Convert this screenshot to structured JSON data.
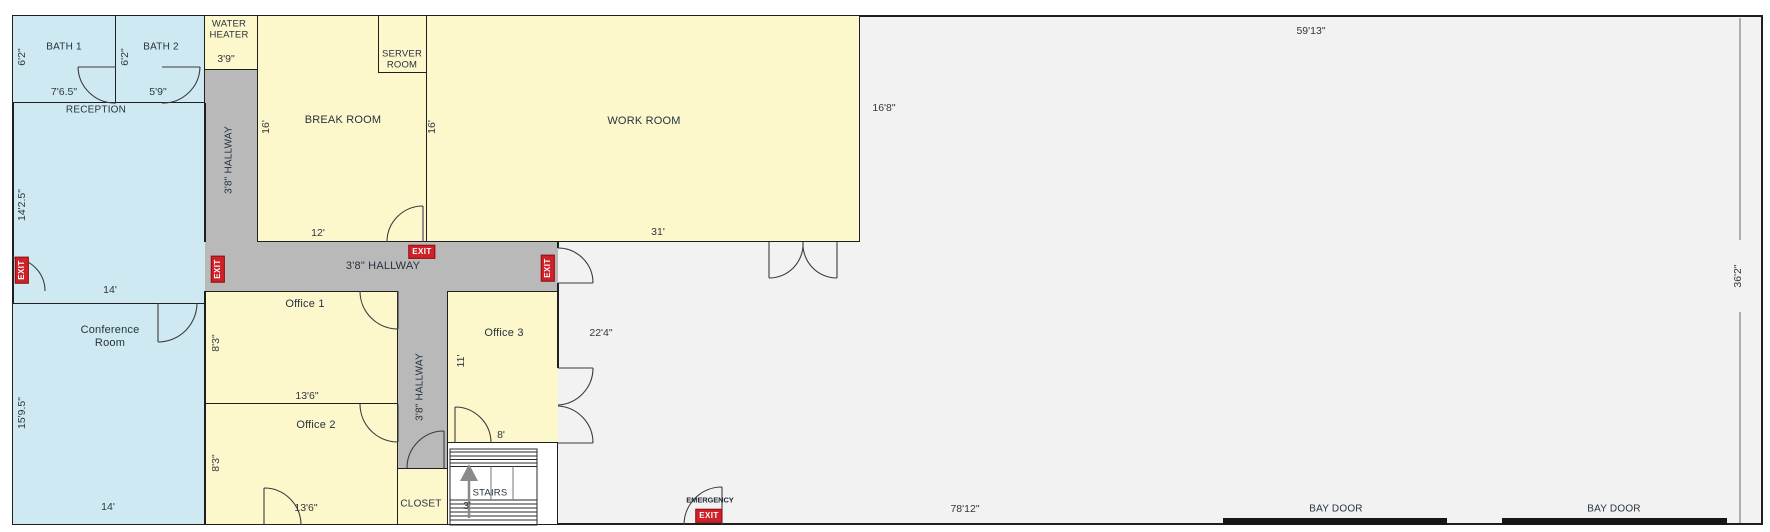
{
  "colors": {
    "room_blue": "#cfe9f2",
    "room_yellow": "#fdf7cc",
    "hallway_gray": "#b9b9b9",
    "warehouse_gray": "#f2f2f2",
    "wall": "#1f1f1f",
    "exit_red": "#cf2128",
    "label_text": "#26323e"
  },
  "rooms": {
    "bath1": {
      "label": "BATH 1",
      "height_dim": "6'2\"",
      "width_dim": "7'6.5\""
    },
    "bath2": {
      "label": "BATH 2",
      "height_dim": "6'2\"",
      "width_dim": "5'9\""
    },
    "reception": {
      "label": "RECEPTION",
      "height_dim": "14'2.5\"",
      "width_dim": "14'"
    },
    "conference": {
      "label": "Conference Room",
      "height_dim": "15'9.5\"",
      "width_dim": "14'"
    },
    "water_heater": {
      "label": "WATER HEATER",
      "width_dim": "3'9\""
    },
    "hallway_top": {
      "label": "3'8\" HALLWAY"
    },
    "break_room": {
      "label": "BREAK ROOM",
      "height_dim": "16'",
      "width_dim": "12'"
    },
    "server_room": {
      "label": "SERVER ROOM"
    },
    "work_room": {
      "label": "WORK ROOM",
      "height_dim_left": "16'",
      "width_dim": "31'",
      "height_dim_right": "16'8\""
    },
    "hallway_main": {
      "label": "3'8\" HALLWAY"
    },
    "office1": {
      "label": "Office 1",
      "height_dim": "8'3\"",
      "width_dim": "13'6\""
    },
    "office2": {
      "label": "Office 2",
      "height_dim": "8'3\"",
      "width_dim": "13'6\""
    },
    "hallway_bottom": {
      "label": "3'8\" HALLWAY"
    },
    "office3": {
      "label": "Office 3",
      "height_dim": "11'",
      "width_dim": "8'"
    },
    "closet": {
      "label": "CLOSET"
    },
    "stairs": {
      "label": "STAIRS",
      "width_dim": "3'"
    },
    "warehouse": {
      "top_dim": "59'13\"",
      "left_dim": "22'4\"",
      "right_dim": "36'2\"",
      "bottom_dim": "78'12\""
    }
  },
  "signs": {
    "exit": "EXIT",
    "emergency": "EMERGENCY"
  },
  "bay_doors": [
    {
      "label": "BAY DOOR"
    },
    {
      "label": "BAY DOOR"
    }
  ]
}
